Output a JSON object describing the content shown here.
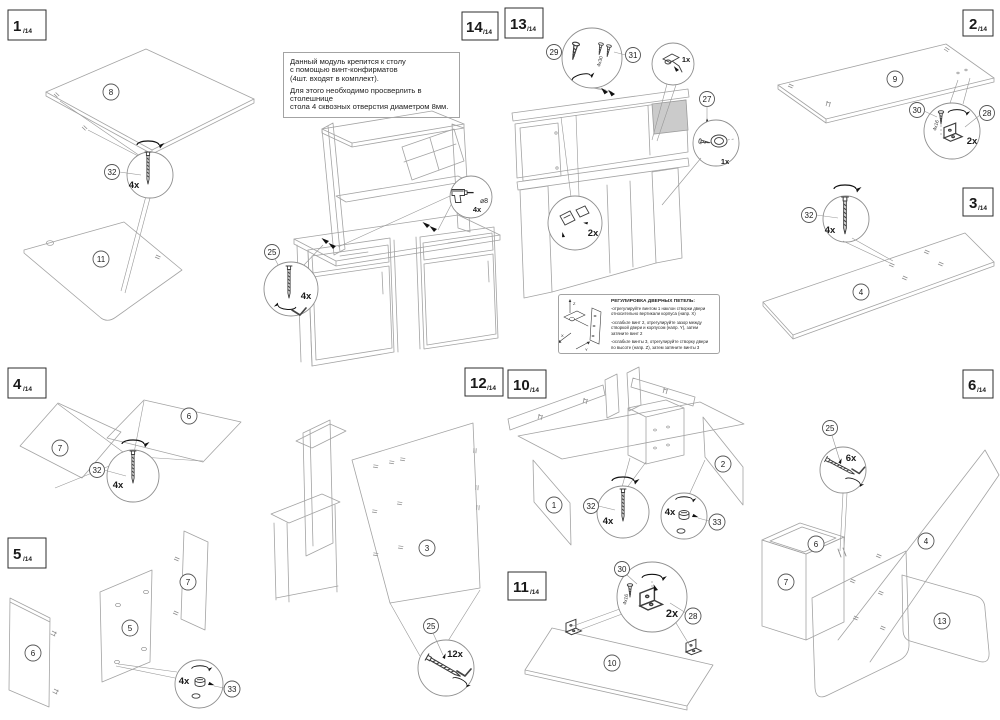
{
  "steps": {
    "s1": {
      "num": "1",
      "den": "/14",
      "part_top": "8",
      "part_bottom": "11",
      "screw": "32",
      "qty": "4x"
    },
    "s2": {
      "num": "2",
      "den": "/14",
      "part": "9",
      "screw": "30",
      "screw_size": "4x16",
      "bracket": "28",
      "qty": "2x"
    },
    "s3": {
      "num": "3",
      "den": "/14",
      "screw": "32",
      "qty": "4x",
      "part": "4"
    },
    "s4": {
      "num": "4",
      "den": "/14",
      "part_left": "7",
      "part_right": "6",
      "screw": "32",
      "qty": "4x"
    },
    "s5": {
      "num": "5",
      "den": "/14",
      "part_left": "6",
      "part_mid": "5",
      "part_right": "7",
      "qty": "4x",
      "cam": "33"
    },
    "s6": {
      "num": "6",
      "den": "/14",
      "screw": "25",
      "qty": "6x",
      "part_box_top": "6",
      "part_box_front": "7",
      "part_long": "4",
      "part_round": "13"
    },
    "s10": {
      "num": "10",
      "den": "/14",
      "part_left": "1",
      "part_right": "2",
      "screw": "32",
      "screw_qty": "4x",
      "cam": "33",
      "cam_qty": "4x"
    },
    "s11": {
      "num": "11",
      "den": "/14",
      "screw": "30",
      "screw_size": "4x16",
      "qty": "2x",
      "bracket": "28",
      "part": "10"
    },
    "s12": {
      "num": "12",
      "den": "/14",
      "part": "3",
      "screw": "25",
      "qty": "12x"
    },
    "s13": {
      "num": "13",
      "den": "/14",
      "screw_a": "29",
      "screw_b": "31",
      "screw_b_size": "4x30",
      "hinge_qty": "1x",
      "cam": "27",
      "cam_qty": "1x",
      "hinge_pair_qty": "2x",
      "note_title": "РЕГУЛИРОВКА ДВЕРНЫХ ПЕТЕЛЬ:",
      "note_l1": "-отрегулируйте винтом 1 наклон створки двери",
      "note_l2": "относительно вертикали корпуса (напр. X)",
      "note_l3": "-ослабьте винт 2, отрегулируйте зазор между",
      "note_l4": "створкой двери и корпусом (напр. Y), затем",
      "note_l5": "затяните винт 2",
      "note_l6": "-ослабьте винты 3, отрегулируйте створку двери",
      "note_l7": "по высоте (напр. Z), затем затяните винты 3",
      "axis_x": "X",
      "axis_y": "Y",
      "axis_z": "Z"
    },
    "s14": {
      "num": "14",
      "den": "/14",
      "screw": "25",
      "qty": "4x",
      "drill_dia": "⌀8",
      "drill_qty": "4x",
      "note_l1": "Данный модуль крепится к столу",
      "note_l2": "с помощью винт-конфирматов",
      "note_l3": "(4шт. входят в комплект).",
      "note_l4": "Для этого необходимо просверлить в столешнице",
      "note_l5": "стола 4 сквозных отверстия диаметром 8мм."
    }
  }
}
